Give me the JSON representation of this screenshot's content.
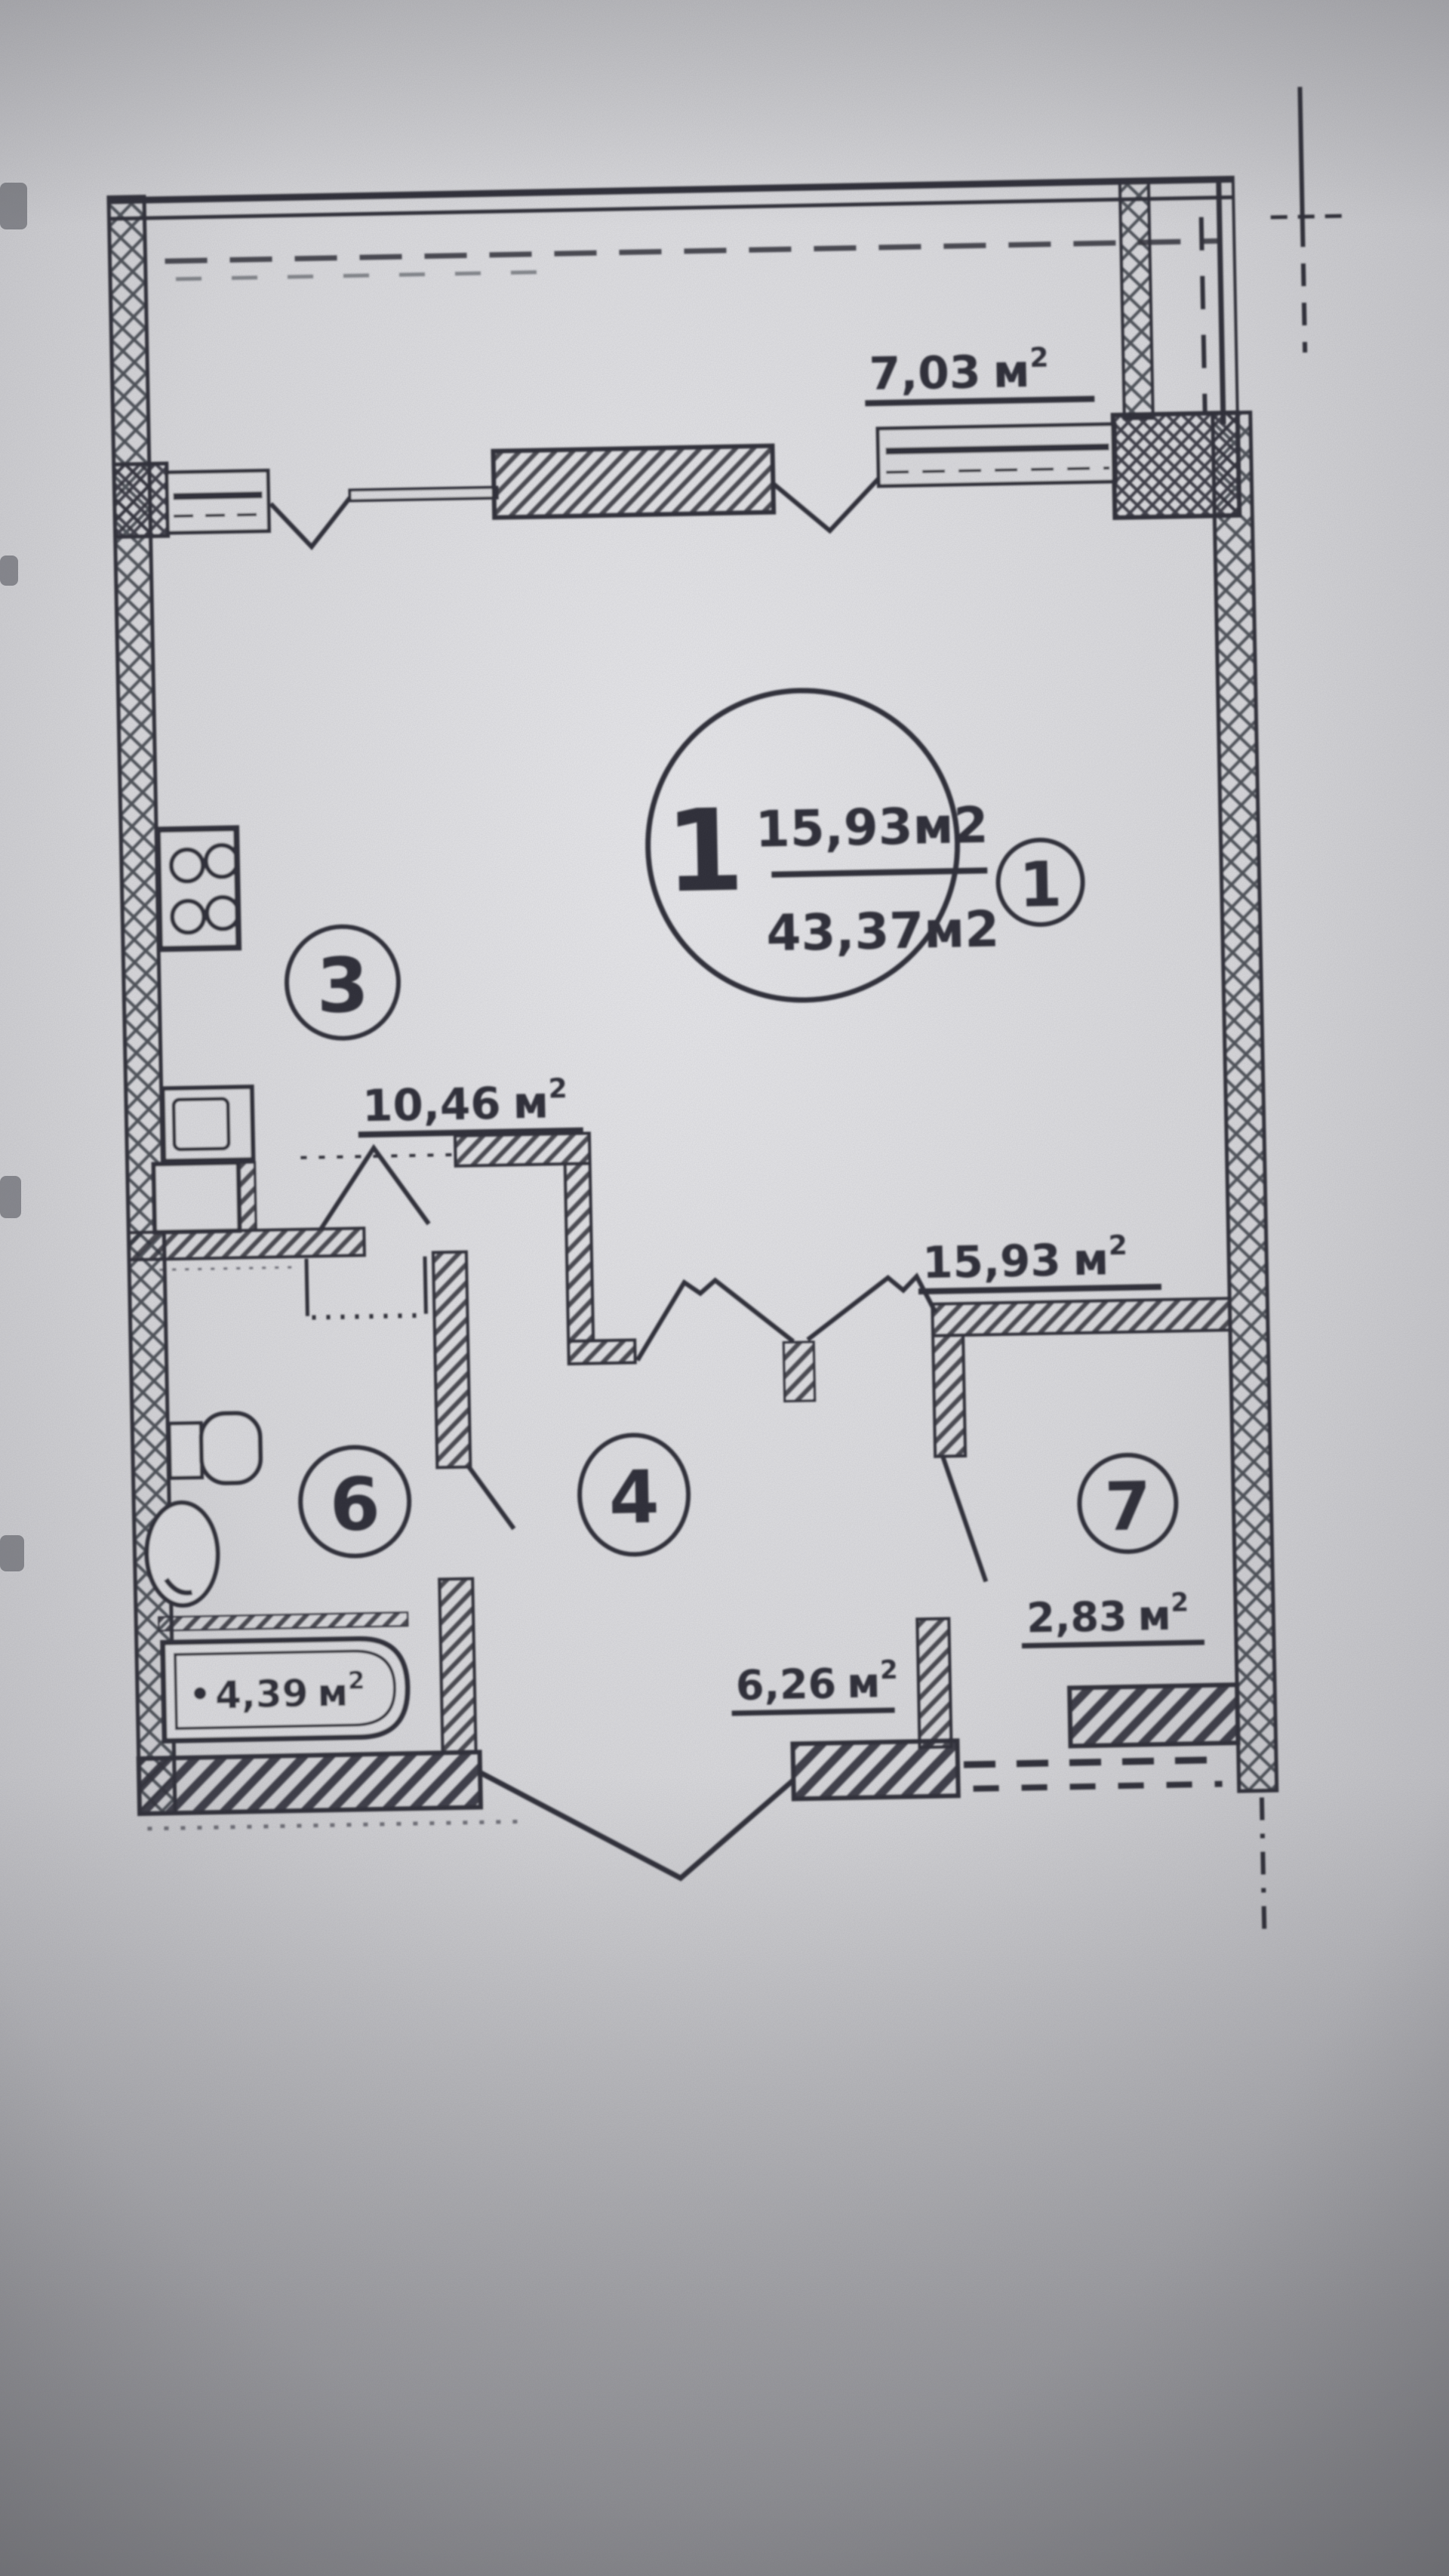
{
  "page": {
    "kind": "photographed architectural floor plan",
    "ink_color": "#2d2f37",
    "paper_color": "#d9d9dc"
  },
  "plan": {
    "type": "apartment floor plan",
    "title_circle": {
      "apartment_number": "1",
      "room_area": "15,93м2",
      "total_area": "43,37м2"
    },
    "room_numbers": {
      "living": "1",
      "kitchen": "3",
      "hall": "4",
      "bath": "6",
      "storage": "7"
    },
    "area_labels": {
      "balcony": {
        "value": "7,03",
        "unit": "м",
        "sup": "2"
      },
      "kitchen": {
        "value": "10,46",
        "unit": "м",
        "sup": "2"
      },
      "living": {
        "value": "15,93",
        "unit": "м",
        "sup": "2"
      },
      "storage": {
        "value": "2,83",
        "unit": "м",
        "sup": "2"
      },
      "hall": {
        "value": "6,26",
        "unit": "м",
        "sup": "2"
      },
      "bath": {
        "value": "4,39",
        "unit": "м",
        "sup": "2"
      }
    }
  }
}
